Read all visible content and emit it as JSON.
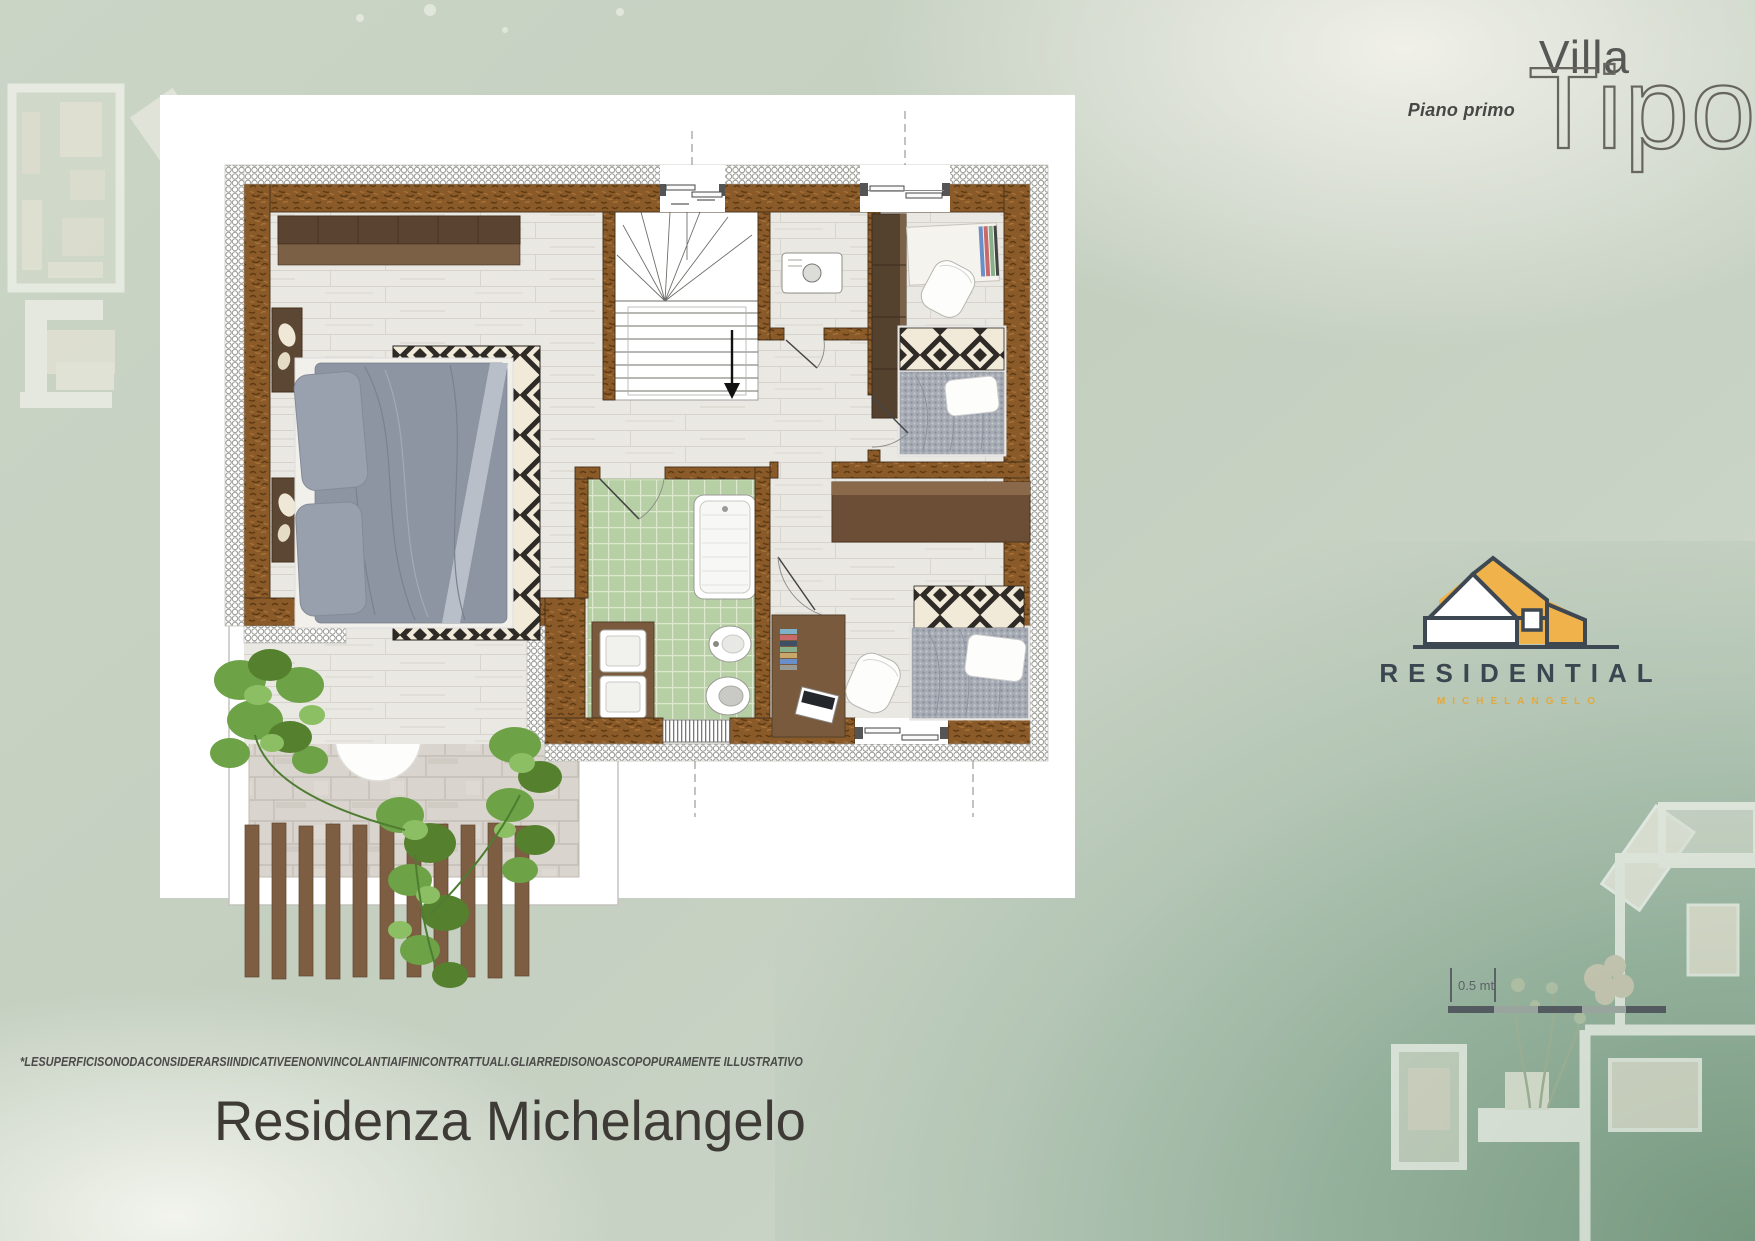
{
  "header": {
    "villa_label": "Villa",
    "tipo_label": "Tipo",
    "floor_label": "Piano primo"
  },
  "logo": {
    "brand": "RESIDENTIAL",
    "sub_brand": "MICHELANGELO",
    "house_icon": "house-icon",
    "accent_color": "#f0b34c",
    "dark_color": "#3d4852"
  },
  "scale_bar": {
    "label": "0.5 mt"
  },
  "footer": {
    "disclaimer": "*LESUPERFICISONODACONSIDERARSIINDICATIVEENONVINCOLANTIAIFINICONTRATTUALI.GLIARREDISONOASCOPOPURAMENTE ILLUSTRATIVO",
    "title": "Residenza Michelangelo"
  },
  "plan": {
    "colors": {
      "wall_brown": "#8a5a28",
      "insulation_white": "#ffffff",
      "bathroom_tile_green": "#b7cfa4",
      "wood_floor": "#eae8e3",
      "terrace_paver": "#d9d5ce",
      "bed_duvet_gray": "#8d95a2",
      "rug_pattern_dark": "#2e2a26",
      "ivy_green": "#6da247",
      "background_sage": "#c8d3c4"
    }
  }
}
